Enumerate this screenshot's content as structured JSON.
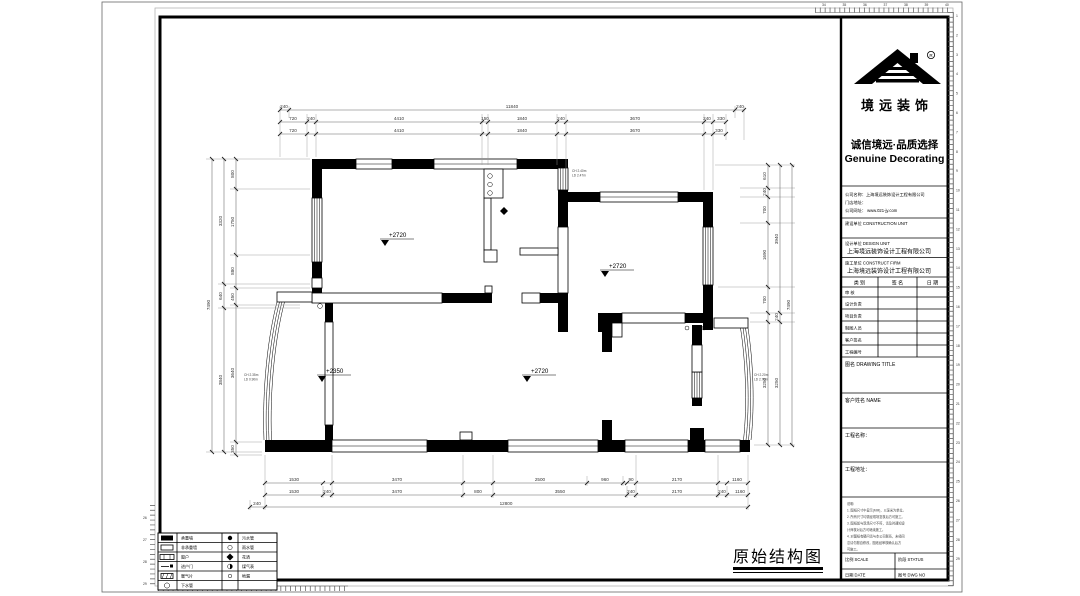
{
  "sheet": {
    "caption": "原始结构图"
  },
  "brand": {
    "name": "境远装饰",
    "registered": "R",
    "slogan_cn": "诚信境远·品质选择",
    "slogan_en": "Genuine Decorating"
  },
  "company": {
    "name_line": "公司名称：上海境远装饰设计工程有限公司",
    "store_line": "门店地址：",
    "web_line": "公司网址： www.021-jy.com"
  },
  "units": {
    "construction": "建设单位 CONSTRUCTION UNIT",
    "design": "设计单位 DESIGN UNIT",
    "design_company": "上海境远装饰设计工程有限公司",
    "builder": "施工单位 CONSTRUCT FIRM",
    "builder_company": "上海境远装饰设计工程有限公司"
  },
  "sign_table": {
    "col_category": "类 别",
    "col_signature": "签 名",
    "col_date": "日 期",
    "rows": [
      "审 核",
      "设计负责",
      "项目负责",
      "制图人员",
      "客户签名",
      "工程编号"
    ]
  },
  "fields": {
    "drawing_title": "图名 DRAWING TITLE",
    "client_name": "客户姓名 NAME",
    "project_name": "工程名称：",
    "project_address": "工程地址："
  },
  "notes": {
    "title": "说明:",
    "lines": [
      "1. 图纸尺寸中显示(MM)，以毫米为单位。",
      "2. 所有尺寸均需经现场复核后方可施工。",
      "3. 图纸如与现场尺寸不符，请及时通知设",
      "    计师核对后方可继续施工。",
      "4. 对图纸有疑问请与本公司联系，未经同",
      "    意请勿擅自修改，图纸经审核确认后方",
      "    可施工。"
    ]
  },
  "footer": {
    "scale": "比例 SCALE",
    "status": "阶段 STATUS",
    "date": "日期 DATE",
    "dwg_no": "图号 DWG NO"
  },
  "legend": {
    "rows": [
      {
        "t1": "承重墙",
        "t2": "污水管"
      },
      {
        "t1": "非承重墙",
        "t2": "雨水管"
      },
      {
        "t1": "窗户",
        "t2": "花洒"
      },
      {
        "t1": "进户门",
        "t2": "煤气表"
      },
      {
        "t1": "暖气片",
        "t2": "地漏"
      },
      {
        "t1": "下水管",
        "t2": ""
      }
    ]
  },
  "plan": {
    "levels": [
      "+2720",
      "+2720",
      "+2350",
      "+2720"
    ],
    "note_top": [
      "CH 2.40m",
      "LD 2.47m"
    ],
    "note_left": [
      "CH 2.35m",
      "LD 0.90m"
    ],
    "note_right": [
      "CH 2.20m",
      "LD 2.70m"
    ],
    "dims": {
      "top1": [
        "240",
        "11840",
        "240"
      ],
      "top2": [
        "720",
        "240",
        "4410",
        "150",
        "1840",
        "240",
        "3670",
        "240",
        "330"
      ],
      "top3": [
        "720",
        "4410",
        "1840",
        "3670",
        "330"
      ],
      "bottom1": [
        "1530",
        "3470",
        "2500",
        "960",
        "90",
        "2170",
        "1160"
      ],
      "bottom2": [
        "1530",
        "240",
        "3470",
        "800",
        "3550",
        "240",
        "2170",
        "240",
        "1160"
      ],
      "bottom3": [
        "240",
        "12800"
      ],
      "left_outer": [
        "7490"
      ],
      "left_mid": [
        "3320",
        "640",
        "3840"
      ],
      "left_inner": [
        "800",
        "1750",
        "880",
        "450",
        "3640",
        "350"
      ],
      "right_inner": [
        "610",
        "240",
        "700",
        "1690",
        "700",
        "3250"
      ],
      "right_mid": [
        "3940",
        "240",
        "3250"
      ],
      "right_outer": [
        "7490"
      ]
    }
  },
  "rulers": {
    "top": [
      "34",
      "35",
      "36",
      "37",
      "38",
      "39",
      "40"
    ],
    "left": [
      "26",
      "27",
      "28",
      "29"
    ],
    "right": [
      "1",
      "2",
      "3",
      "4",
      "5",
      "6",
      "7",
      "8",
      "9",
      "10",
      "11",
      "12",
      "13",
      "14",
      "15",
      "16",
      "17",
      "18",
      "19",
      "20",
      "21",
      "22",
      "23",
      "24",
      "25",
      "26",
      "27",
      "28",
      "29"
    ]
  }
}
